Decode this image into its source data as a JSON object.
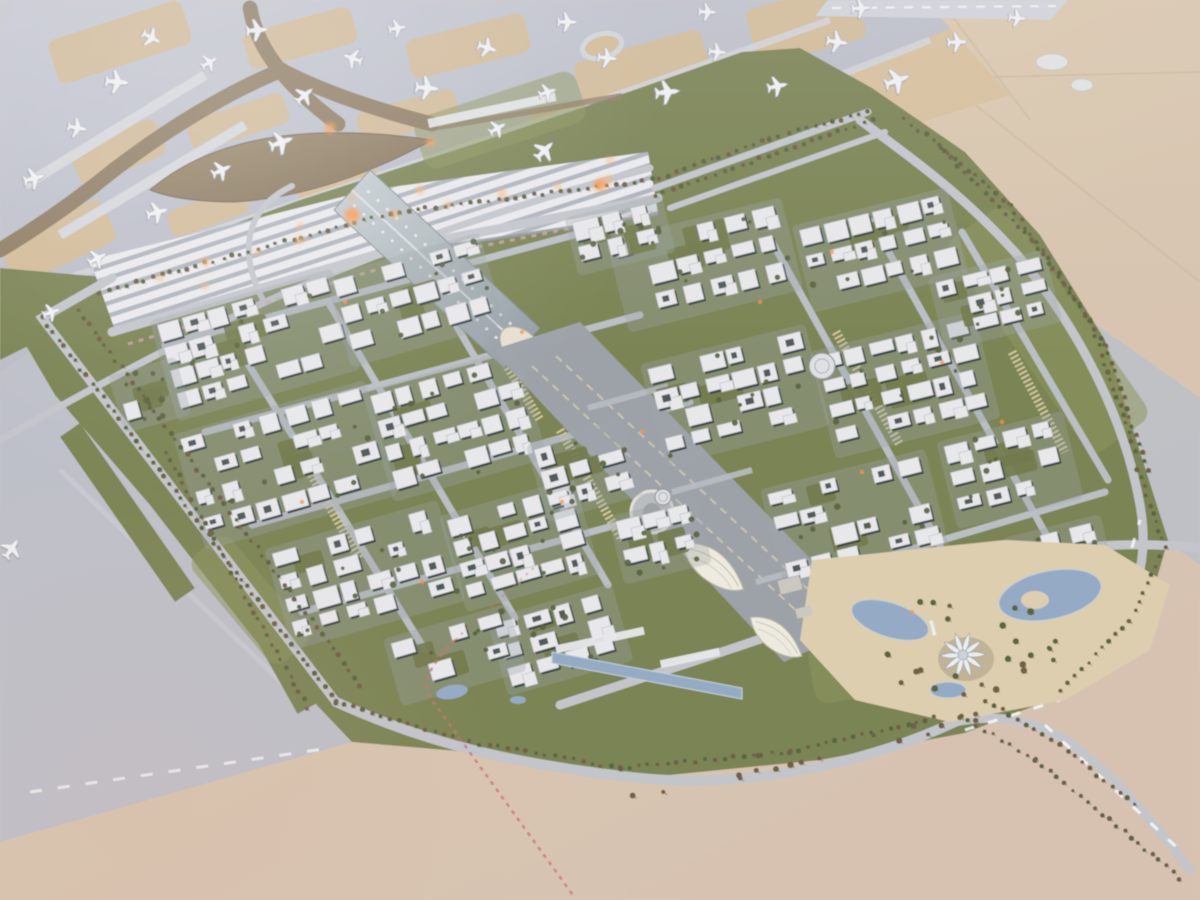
{
  "scene": {
    "alt": "Aerial photograph of an architectural scale model of an airport city: runways and aprons with model airplanes at top, a white ribbed terminal concourse with a brown curved roof, a silver arched station hall leading to a central boulevard lined with building blocks, palm-lined ring roads, desert sand around, and a lotus-flower landmark in a park at lower right",
    "type": "photograph-of-scale-model"
  },
  "palette": {
    "sandLight": "#e2cfae",
    "sandMid": "#d9c6ad",
    "sandPink": "#d7c2b2",
    "apron": "#b9bdc8",
    "apronLight": "#c9ccd5",
    "taxiline": "#d2d5dc",
    "tanPatch": "#d3bb93",
    "runwayStrip": "#d0d4db",
    "green": "#77814f",
    "greenLight": "#8a935a",
    "greenDark": "#5c673c",
    "treeOlive": "#55603a",
    "palmBrown": "#6b5b40",
    "palmShadow": "#7a6a4e",
    "road": "#c2c6cc",
    "roadMinor": "#b9bfc5",
    "parking": "#d9cfa6",
    "roofWhite": "#e9eaee",
    "wallDark": "#2f3c3c",
    "roofStroke": "#b6bbc2",
    "concourseRib": "#ecedf1",
    "concourseGap": "#aeb3bd",
    "concourseEdge": "#8e94a2",
    "terminalBrown1": "#9a8768",
    "terminalBrown2": "#7d6d55",
    "brownRoad": "#8c7a5e",
    "archLight": "#c9d2d6",
    "archDark": "#8d99a0",
    "archRidge": "#e2e8ea",
    "blvd": "#9aa1a7",
    "blvdLine": "#cfc8ae",
    "canopyWhite": "#efece1",
    "canopyEdge": "#b8b2a2",
    "water": "#92aac6",
    "waterEdge": "#c6d1da",
    "lotusPetal": "#eef0f2",
    "lotusEdge": "#9aa2ac",
    "parkSand": "#decfae",
    "glowOrange": "#ff9a4e",
    "windowOrange": "#ff8c4a",
    "railPink": "#c96f6f",
    "planeFill": "#f3f4f7",
    "planeEdge": "#aeb2bc",
    "grayBand": "#bcc0c8",
    "desertLine": "#cbb89a",
    "white": "#ffffff"
  },
  "apron": {
    "poly": [
      [
        0,
        0
      ],
      [
        925,
        0
      ],
      [
        950,
        28
      ],
      [
        845,
        75
      ],
      [
        700,
        120
      ],
      [
        545,
        170
      ],
      [
        420,
        210
      ],
      [
        300,
        258
      ],
      [
        185,
        315
      ],
      [
        90,
        380
      ],
      [
        0,
        432
      ]
    ],
    "patches": [
      [
        120,
        42,
        140,
        46,
        -18
      ],
      [
        300,
        38,
        112,
        38,
        -15
      ],
      [
        468,
        46,
        122,
        40,
        -14
      ],
      [
        642,
        68,
        132,
        46,
        -16
      ],
      [
        806,
        24,
        112,
        58,
        -15
      ],
      [
        238,
        122,
        102,
        32,
        -18
      ],
      [
        408,
        116,
        102,
        32,
        -15
      ],
      [
        576,
        116,
        92,
        30,
        -15
      ],
      [
        118,
        152,
        92,
        40,
        -22
      ],
      [
        58,
        242,
        112,
        46,
        -25
      ],
      [
        208,
        212,
        82,
        28,
        -20
      ],
      [
        338,
        182,
        82,
        26,
        -16
      ],
      [
        700,
        120,
        90,
        40,
        -18
      ],
      [
        35,
        390,
        70,
        34,
        -28
      ]
    ],
    "taxiways": [
      "M60,380 C300,270 600,170 930,40",
      "M0,300 C250,220 520,130 830,20",
      "M150,330 L520,195"
    ],
    "piers": [
      "M205,75 L25,185",
      "M245,125 L60,235"
    ],
    "loopEllipse": [
      602,
      46,
      20,
      12,
      -15
    ],
    "runwayStrip": [
      [
        828,
        0
      ],
      [
        1068,
        0
      ],
      [
        1050,
        20
      ],
      [
        815,
        16
      ]
    ],
    "tanWedge": [
      [
        845,
        75
      ],
      [
        950,
        28
      ],
      [
        1010,
        95
      ],
      [
        880,
        135
      ]
    ],
    "apronB": [
      [
        0,
        372
      ],
      [
        55,
        335
      ],
      [
        340,
        705
      ],
      [
        352,
        742
      ],
      [
        0,
        842
      ]
    ],
    "apronBDash": "M30,792 L330,748",
    "sandNotch": [
      [
        0,
        420
      ],
      [
        60,
        428
      ],
      [
        40,
        470
      ],
      [
        0,
        478
      ]
    ]
  },
  "planes": [
    [
      35,
      178,
      75,
      1.1
    ],
    [
      78,
      128,
      100,
      1.0
    ],
    [
      118,
      82,
      95,
      1.2
    ],
    [
      152,
      38,
      118,
      1.0
    ],
    [
      210,
      62,
      60,
      0.9
    ],
    [
      258,
      30,
      85,
      1.1
    ],
    [
      305,
      95,
      50,
      1.0
    ],
    [
      282,
      142,
      70,
      1.2
    ],
    [
      222,
      170,
      65,
      1.0
    ],
    [
      158,
      212,
      75,
      1.1
    ],
    [
      98,
      258,
      62,
      1.0
    ],
    [
      52,
      312,
      70,
      0.9
    ],
    [
      352,
      58,
      -70,
      1.0
    ],
    [
      398,
      28,
      80,
      0.9
    ],
    [
      428,
      88,
      95,
      1.2
    ],
    [
      488,
      48,
      108,
      1.0
    ],
    [
      545,
      150,
      45,
      1.1
    ],
    [
      548,
      92,
      72,
      0.9
    ],
    [
      608,
      58,
      96,
      1.0
    ],
    [
      668,
      92,
      84,
      1.2
    ],
    [
      718,
      52,
      95,
      0.9
    ],
    [
      778,
      86,
      78,
      1.0
    ],
    [
      838,
      42,
      98,
      1.1
    ],
    [
      898,
      80,
      70,
      1.3
    ],
    [
      958,
      42,
      88,
      1.0
    ],
    [
      1018,
      18,
      96,
      0.9
    ],
    [
      568,
      22,
      90,
      1.0
    ],
    [
      708,
      12,
      92,
      0.9
    ],
    [
      862,
      8,
      86,
      1.0
    ],
    [
      12,
      548,
      35,
      1.1
    ],
    [
      498,
      128,
      60,
      0.9
    ]
  ],
  "desert": {
    "lines": [
      "M880,30 L1200,282",
      "M950,78 L1200,72",
      "M940,0 L1030,120"
    ],
    "blobs": [
      [
        1052,
        62,
        16,
        8
      ],
      [
        1082,
        85,
        11,
        6
      ]
    ],
    "grayBand": [
      [
        1008,
        262
      ],
      [
        1200,
        398
      ],
      [
        1200,
        565
      ],
      [
        1042,
        452
      ]
    ]
  },
  "green": {
    "plate": [
      [
        18,
        332
      ],
      [
        140,
        258
      ],
      [
        300,
        200
      ],
      [
        480,
        142
      ],
      [
        640,
        88
      ],
      [
        742,
        52
      ],
      [
        800,
        48
      ],
      [
        872,
        88
      ],
      [
        965,
        152
      ],
      [
        1040,
        235
      ],
      [
        1105,
        340
      ],
      [
        1140,
        452
      ],
      [
        1168,
        540
      ],
      [
        1150,
        602
      ],
      [
        1075,
        690
      ],
      [
        965,
        733
      ],
      [
        820,
        760
      ],
      [
        640,
        778
      ],
      [
        470,
        752
      ],
      [
        352,
        742
      ],
      [
        255,
        640
      ],
      [
        150,
        505
      ],
      [
        55,
        395
      ]
    ],
    "westStrip": [
      [
        0,
        268
      ],
      [
        115,
        278
      ],
      [
        60,
        330
      ],
      [
        0,
        360
      ]
    ],
    "apronBStrip": [
      "M165,452 L308,708",
      "M70,430 L185,595"
    ],
    "lightPatches": [
      [
        500,
        120,
        170,
        54,
        -18
      ],
      [
        1048,
        330,
        260,
        74,
        55
      ],
      [
        900,
        660,
        180,
        60,
        -10
      ],
      [
        250,
        600,
        140,
        50,
        50
      ]
    ]
  },
  "roads": [
    {
      "d": "M112,278 L42,318 L336,702",
      "w": 9,
      "c": "road"
    },
    {
      "d": "M336,702 C430,745 520,765 640,778 C760,790 880,757 955,722",
      "w": 10,
      "c": "road"
    },
    {
      "d": "M955,722 C1010,700 1060,672 1100,640 C1135,612 1150,560 1140,505",
      "w": 9,
      "c": "road"
    },
    {
      "d": "M955,722 C1005,712 1045,722 1082,752 C1120,782 1160,830 1190,870",
      "w": 9,
      "c": "road"
    },
    {
      "d": "M1140,505 C1125,420 1080,330 1020,258 C960,190 900,150 860,120",
      "w": 9,
      "c": "road"
    },
    {
      "d": "M655,188 L868,112",
      "w": 7,
      "c": "road"
    },
    {
      "d": "M670,208 L885,132",
      "w": 6,
      "c": "road"
    },
    {
      "d": "M560,705 C680,665 760,642 860,602 C960,562 1080,535 1200,548",
      "w": 9,
      "c": "road"
    },
    {
      "d": "M112,332 L398,248 L658,198",
      "w": 9,
      "c": "road"
    },
    {
      "d": "M0,440 C120,372 240,308 370,258 C470,220 560,192 650,168",
      "w": 7,
      "c": "road"
    },
    {
      "d": "M262,298 C238,250 246,208 292,186",
      "w": 6,
      "c": "road"
    },
    {
      "d": "M165,345 L585,232",
      "w": 7,
      "c": "roadMinor"
    },
    {
      "d": "M205,432 L640,315",
      "w": 7,
      "c": "roadMinor"
    },
    {
      "d": "M252,525 L690,402",
      "w": 7,
      "c": "roadMinor"
    },
    {
      "d": "M302,612 L735,492",
      "w": 7,
      "c": "roadMinor"
    },
    {
      "d": "M790,585 L1105,492",
      "w": 7,
      "c": "roadMinor"
    },
    {
      "d": "M232,338 L425,650",
      "w": 7,
      "c": "roadMinor"
    },
    {
      "d": "M330,305 L515,618",
      "w": 7,
      "c": "roadMinor"
    },
    {
      "d": "M425,272 L608,585",
      "w": 7,
      "c": "roadMinor"
    },
    {
      "d": "M772,242 L948,560",
      "w": 7,
      "c": "roadMinor"
    },
    {
      "d": "M872,222 L1048,538",
      "w": 7,
      "c": "roadMinor"
    },
    {
      "d": "M962,232 L1108,480",
      "w": 7,
      "c": "roadMinor"
    }
  ],
  "roadDashes": [
    "M1045,725 L1185,855",
    "M1105,640 L1140,520",
    "M965,730 L1060,700"
  ],
  "parking": [
    "M468,302 L540,420",
    "M560,430 L622,540",
    "M836,332 L900,445",
    "M300,455 L360,560",
    "M1012,352 L1065,452"
  ],
  "flowerbed": "M128,344 L402,262 L652,212",
  "terminal": {
    "leaf": "M150,190 Q240,112 432,140 Q330,196 236,202 Q180,202 150,190 Z",
    "roads": [
      "M250,8 C258,55 295,92 338,124",
      "M285,72 C330,95 385,112 432,124",
      "M282,70 C220,95 150,140 95,185 C60,212 30,232 0,250"
    ],
    "landsideStrip": [
      492,
      110,
      130,
      9,
      -12
    ],
    "thinBand": "M432,128 C500,118 560,106 622,96"
  },
  "concourse": {
    "quadA": [
      [
        90,
        260
      ],
      [
        370,
        190
      ],
      [
        385,
        255
      ],
      [
        115,
        330
      ]
    ],
    "quadB": [
      [
        370,
        190
      ],
      [
        648,
        152
      ],
      [
        658,
        214
      ],
      [
        385,
        255
      ]
    ],
    "edge": "M115,330 L385,255 L658,214"
  },
  "arch": {
    "body": [
      [
        334,
        210
      ],
      [
        370,
        170
      ],
      [
        540,
        328
      ],
      [
        504,
        368
      ]
    ],
    "ridge": "M352,190 L522,348",
    "endArch": [
      522,
      348,
      26,
      16,
      43
    ],
    "canopies": [
      [
        560,
        372
      ],
      [
        583,
        398
      ],
      [
        608,
        424
      ],
      [
        634,
        450
      ]
    ]
  },
  "boulevard": {
    "band": [
      [
        492,
        350
      ],
      [
        580,
        322
      ],
      [
        872,
        622
      ],
      [
        784,
        662
      ]
    ],
    "tracks": [
      "M532,366 L828,640",
      "M556,356 L850,628"
    ],
    "plaza": [
      652,
      512,
      21,
      9
    ],
    "leaves": [
      [
        712,
        568,
        1.0,
        40
      ],
      [
        775,
        638,
        0.85,
        40
      ]
    ],
    "crossings": [
      "M588,408 L668,386",
      "M672,492 L752,470",
      "M756,582 L836,560"
    ]
  },
  "clusters": [
    [
      255,
      345,
      180,
      95,
      -16,
      11
    ],
    [
      415,
      300,
      150,
      85,
      -16,
      21
    ],
    [
      285,
      465,
      190,
      110,
      -16,
      31
    ],
    [
      455,
      425,
      150,
      105,
      -16,
      41
    ],
    [
      365,
      575,
      170,
      95,
      -16,
      51
    ],
    [
      520,
      545,
      130,
      90,
      -16,
      61
    ],
    [
      585,
      470,
      90,
      70,
      -16,
      71
    ],
    [
      560,
      640,
      120,
      70,
      -16,
      81
    ],
    [
      705,
      265,
      170,
      85,
      -14,
      91
    ],
    [
      880,
      250,
      150,
      80,
      -14,
      101
    ],
    [
      735,
      395,
      160,
      95,
      -14,
      111
    ],
    [
      905,
      385,
      160,
      100,
      -14,
      121
    ],
    [
      995,
      300,
      110,
      65,
      -14,
      131
    ],
    [
      855,
      520,
      160,
      95,
      -14,
      141
    ],
    [
      1010,
      470,
      120,
      80,
      -14,
      151
    ],
    [
      935,
      625,
      170,
      90,
      -14,
      161
    ],
    [
      660,
      540,
      80,
      60,
      -14,
      171
    ],
    [
      1060,
      560,
      90,
      60,
      -14,
      181
    ],
    [
      620,
      235,
      90,
      50,
      -14,
      191
    ],
    [
      455,
      655,
      120,
      60,
      -16,
      201
    ],
    [
      150,
      395,
      60,
      50,
      -16,
      211
    ]
  ],
  "roundBuildings": [
    [
      822,
      366,
      13
    ],
    [
      663,
      497,
      8
    ]
  ],
  "canal": {
    "main": [
      [
        552,
        652
      ],
      [
        742,
        688
      ],
      [
        742,
        699
      ],
      [
        552,
        663
      ]
    ],
    "ponds": [
      [
        452,
        692,
        16,
        7,
        -10
      ],
      [
        518,
        700,
        8,
        4,
        0
      ]
    ],
    "strip": [
      [
        600,
        640,
        90,
        8,
        -12
      ],
      [
        690,
        658,
        60,
        8,
        -12
      ]
    ]
  },
  "park": {
    "sand": [
      [
        812,
        560
      ],
      [
        1005,
        540
      ],
      [
        1105,
        545
      ],
      [
        1170,
        585
      ],
      [
        1150,
        650
      ],
      [
        1065,
        700
      ],
      [
        950,
        722
      ],
      [
        855,
        700
      ],
      [
        800,
        640
      ]
    ],
    "ponds": [
      [
        1050,
        595,
        52,
        24,
        -12
      ],
      [
        890,
        620,
        40,
        17,
        18
      ],
      [
        948,
        690,
        18,
        8,
        0
      ]
    ],
    "lotus": [
      963,
      655
    ],
    "tower": [
      940,
      628
    ],
    "plazas": [
      [
        790,
        585,
        22,
        14,
        -14
      ],
      [
        804,
        612,
        16,
        10,
        -14
      ]
    ]
  },
  "palmRows": [
    [
      [
        42,
        318
      ],
      [
        336,
        702
      ]
    ],
    [
      [
        78,
        310
      ],
      [
        360,
        685
      ]
    ],
    [
      [
        100,
        292
      ],
      [
        390,
        213
      ],
      [
        652,
        180
      ]
    ],
    [
      [
        660,
        178
      ],
      [
        770,
        138
      ],
      [
        868,
        112
      ]
    ],
    [
      [
        905,
        118
      ],
      [
        1010,
        205
      ],
      [
        1090,
        320
      ],
      [
        1135,
        450
      ]
    ],
    [
      [
        938,
        145
      ],
      [
        1032,
        240
      ],
      [
        1105,
        345
      ],
      [
        1148,
        470
      ]
    ],
    [
      [
        1138,
        470
      ],
      [
        1165,
        548
      ],
      [
        1130,
        620
      ],
      [
        1060,
        690
      ]
    ],
    [
      [
        336,
        702
      ],
      [
        470,
        742
      ],
      [
        620,
        768
      ],
      [
        790,
        752
      ],
      [
        935,
        718
      ]
    ],
    [
      [
        960,
        715
      ],
      [
        1035,
        760
      ],
      [
        1110,
        820
      ],
      [
        1180,
        878
      ]
    ],
    [
      [
        985,
        700
      ],
      [
        1060,
        745
      ],
      [
        1135,
        805
      ]
    ],
    [
      [
        165,
        452
      ],
      [
        308,
        708
      ]
    ],
    [
      [
        655,
        195
      ],
      [
        872,
        120
      ]
    ]
  ],
  "bermTrees": {
    "band": [
      [
        620,
        795
      ],
      [
        1000,
        715
      ]
    ],
    "count": 18
  },
  "parkTrees": {
    "center": [
      963,
      648
    ],
    "count": 26,
    "rmin": 48,
    "rmax": 95
  },
  "rail": {
    "main": "M455,640 C428,668 420,684 432,700 L575,898",
    "faint": "M455,640 L540,562"
  },
  "glows": {
    "big": [
      [
        352,
        215,
        7
      ],
      [
        600,
        185,
        6
      ],
      [
        330,
        128,
        5
      ],
      [
        430,
        142,
        4
      ]
    ],
    "band": [
      [
        160,
        278,
        3
      ],
      [
        205,
        262,
        4
      ],
      [
        258,
        252,
        3
      ],
      [
        300,
        240,
        4
      ],
      [
        352,
        222,
        3
      ],
      [
        395,
        214,
        4
      ],
      [
        448,
        204,
        3
      ],
      [
        502,
        194,
        4
      ],
      [
        558,
        186,
        3
      ],
      [
        608,
        180,
        4
      ],
      [
        352,
        198,
        3
      ],
      [
        300,
        226,
        3
      ],
      [
        205,
        286,
        3
      ],
      [
        610,
        160,
        3
      ],
      [
        420,
        190,
        4
      ]
    ],
    "windows": [
      [
        345,
        302
      ],
      [
        522,
        332
      ],
      [
        760,
        302
      ],
      [
        942,
        362
      ],
      [
        642,
        432
      ],
      [
        862,
        472
      ],
      [
        1002,
        422
      ],
      [
        302,
        502
      ],
      [
        562,
        502
      ],
      [
        832,
        252
      ],
      [
        912,
        612
      ],
      [
        422,
        582
      ]
    ]
  }
}
